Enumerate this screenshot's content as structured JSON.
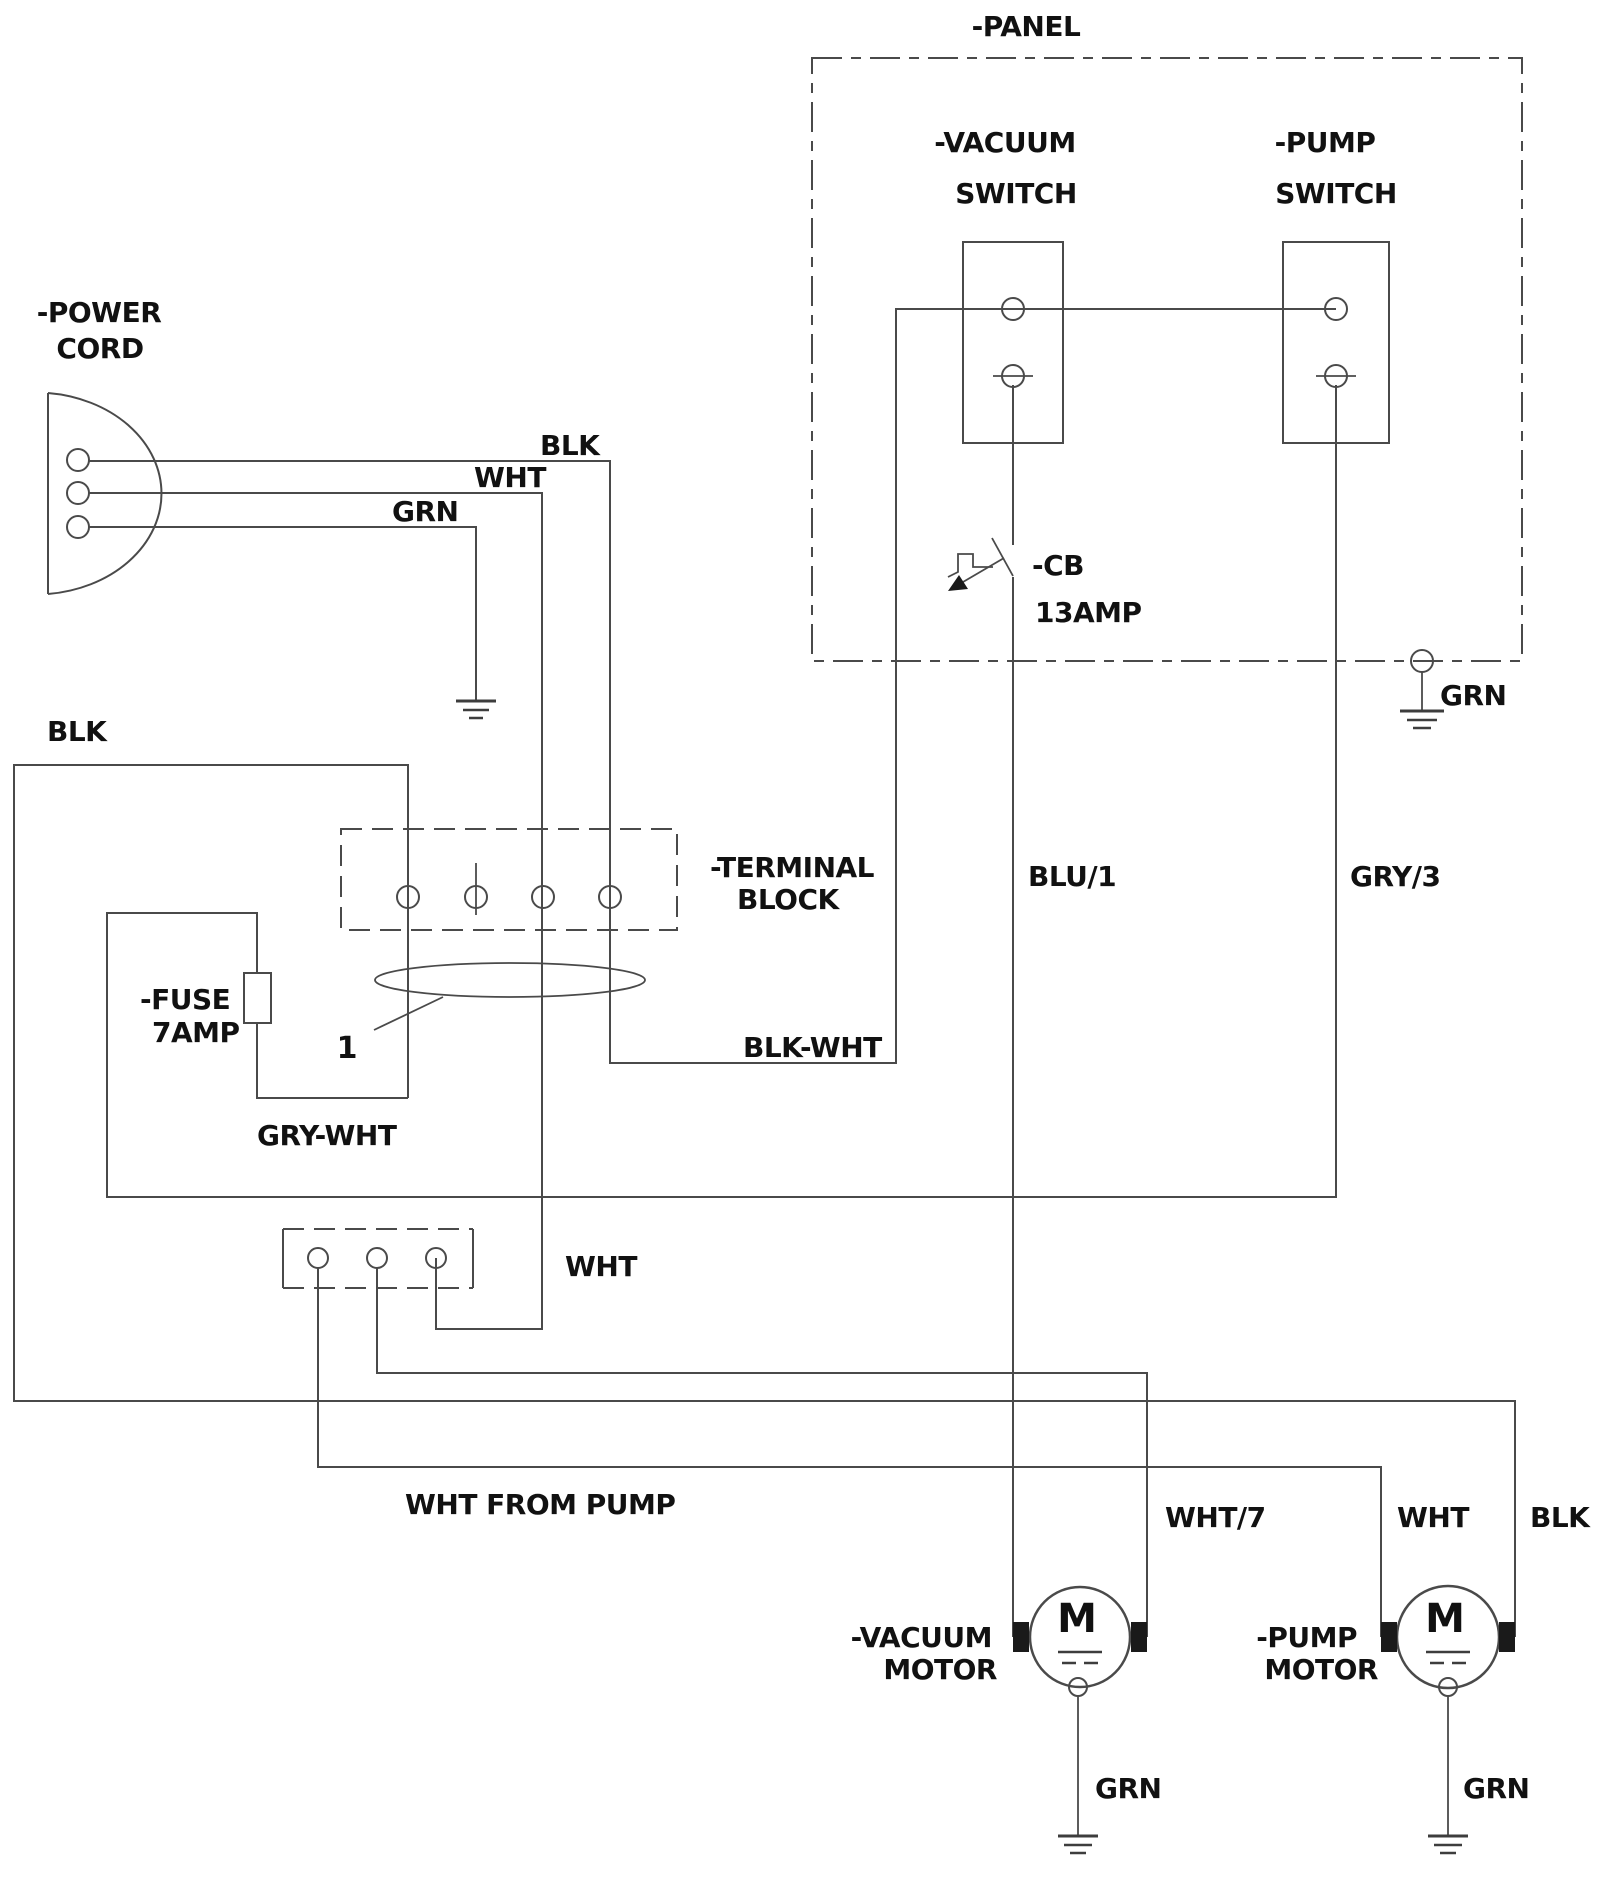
{
  "diagram": {
    "panel": {
      "label": "-PANEL"
    },
    "vacuum_switch": {
      "name_line1": "-VACUUM",
      "name_line2": "SWITCH"
    },
    "pump_switch": {
      "name_line1": "-PUMP",
      "name_line2": "SWITCH"
    },
    "circuit_breaker": {
      "name": "-CB",
      "rating": "13AMP"
    },
    "panel_ground": {
      "label": "GRN"
    },
    "power_cord": {
      "name_line1": "-POWER",
      "name_line2": "CORD",
      "blk": "BLK",
      "wht": "WHT",
      "grn": "GRN"
    },
    "blk_feed": {
      "label": "BLK"
    },
    "terminal_block": {
      "name_line1": "-TERMINAL",
      "name_line2": "BLOCK"
    },
    "fuse": {
      "name": "-FUSE",
      "rating": "7AMP"
    },
    "bundle": {
      "label": "1"
    },
    "gry_wht": {
      "label": "GRY-WHT"
    },
    "blk_wht": {
      "label": "BLK-WHT"
    },
    "pump_terminal_block": {
      "wht": "WHT"
    },
    "blu1": {
      "label": "BLU/1"
    },
    "gry3": {
      "label": "GRY/3"
    },
    "wht_from_pump": {
      "label": "WHT FROM PUMP"
    },
    "wht7": {
      "label": "WHT/7"
    },
    "pump_wht": {
      "label": "WHT"
    },
    "pump_blk": {
      "label": "BLK"
    },
    "vacuum_motor": {
      "name_line1": "-VACUUM",
      "name_line2": "MOTOR",
      "symbol": "M",
      "ground": "GRN"
    },
    "pump_motor": {
      "name_line1": "-PUMP",
      "name_line2": "MOTOR",
      "symbol": "M",
      "ground": "GRN"
    }
  }
}
